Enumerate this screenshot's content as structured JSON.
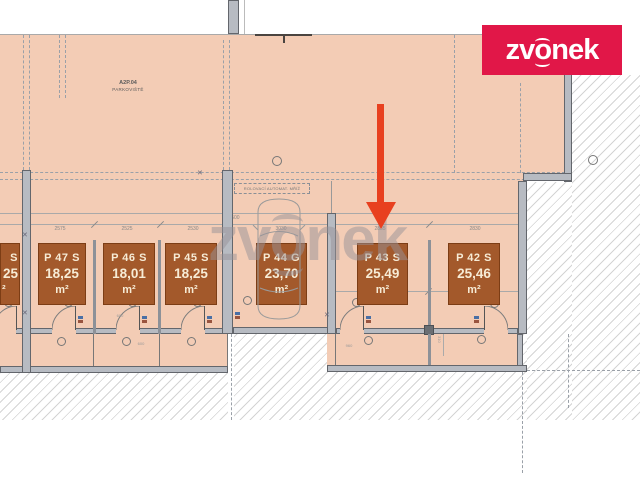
{
  "logo": {
    "part1": "zv",
    "part2": "o",
    "part3": "nek"
  },
  "watermark": {
    "part1": "zv",
    "part2": "o",
    "part3": "nek"
  },
  "zone": {
    "code": "A2P.04",
    "name": "PARKOVIŠTĚ"
  },
  "grille_label": "ROLOVACÍ AUTOMAT. MŘÍŽ",
  "stalls": {
    "partial": {
      "label": "S",
      "area": "25",
      "unit": "²"
    },
    "p47": {
      "label": "P 47 S",
      "area": "18,25",
      "unit": "m²"
    },
    "p46": {
      "label": "P 46 S",
      "area": "18,01",
      "unit": "m²"
    },
    "p45": {
      "label": "P 45 S",
      "area": "18,25",
      "unit": "m²"
    },
    "p44": {
      "label": "P 44 G",
      "area": "23,70",
      "unit": "m²"
    },
    "p43": {
      "label": "P 43 S",
      "area": "25,49",
      "unit": "m²"
    },
    "p42": {
      "label": "P 42 S",
      "area": "25,46",
      "unit": "m²"
    }
  },
  "dimensions": {
    "upper": "7500",
    "chain": [
      "2575",
      "2525",
      "2530",
      "3030",
      "2835",
      "2830"
    ],
    "cell_a": "600",
    "cell_b": "960",
    "door_a": "600",
    "vert": "310"
  },
  "colors": {
    "floor_peach": "#f3ccb5",
    "stall_brown": "#a3592b",
    "brand_crimson": "#e11748",
    "arrow_red": "#e8401f"
  }
}
